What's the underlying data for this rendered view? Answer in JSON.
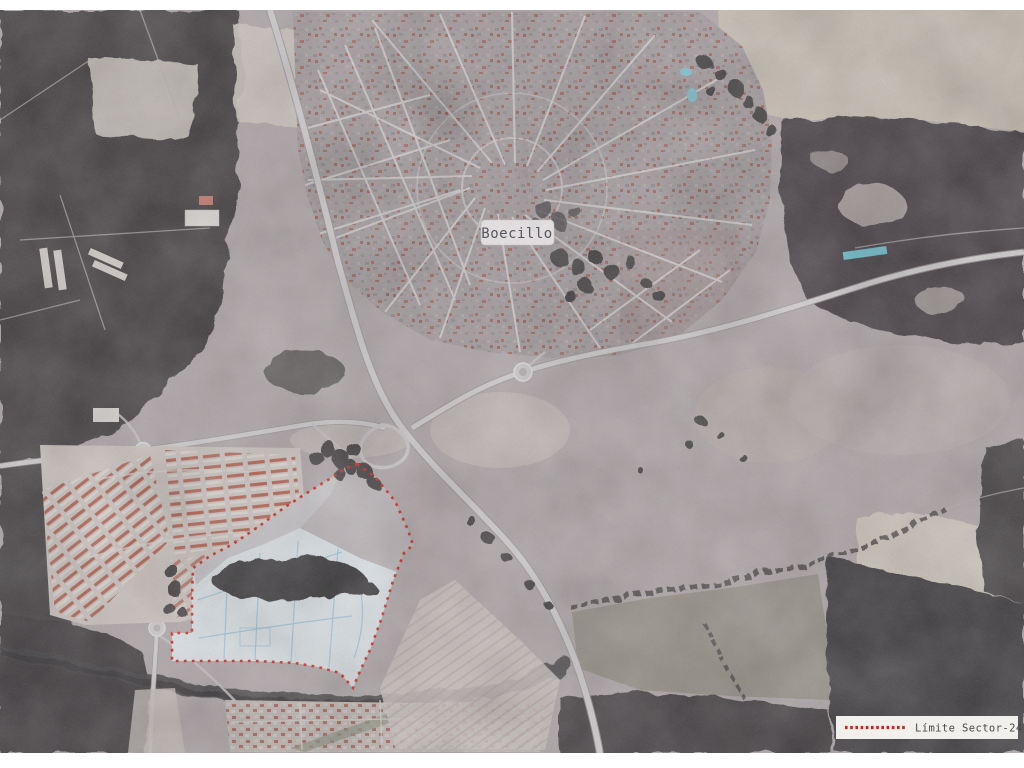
{
  "map": {
    "type": "aerial-photograph",
    "town_label": "Boecillo",
    "sector": {
      "name": "Sector-24",
      "boundary_color": "#cf2b1d",
      "boundary_dash": "2.8 5.2",
      "outline_points": "357,464 375,477 395,501 408,530 413,545 404,553 393,581 381,620 370,650 360,671 353,688 340,673 318,667 295,663 255,661 210,661 172,661 172,633 192,633 192,597 193,568 210,556 233,544 258,527 285,507 310,491 331,478 346,468"
    },
    "legend": {
      "label": "Límite Sector-24",
      "background": "#f2f0ed",
      "text_color": "#47474b",
      "swatch_color": "#c2281c",
      "swatch_dash": "2.6 2.6"
    },
    "colors": {
      "fields": "#aea5a7",
      "forest": "#454043",
      "roads": "#cfcbcc",
      "road_edge": "#9a9294",
      "town": "#a29a9c",
      "sector_fill": "#dbe1e6",
      "parcel_lines": "#9cc2d8",
      "house_roofs": "#b26454",
      "pool_water": "#6fbccb",
      "label_bg": "#e6e3e4",
      "label_text": "#54555e"
    }
  }
}
